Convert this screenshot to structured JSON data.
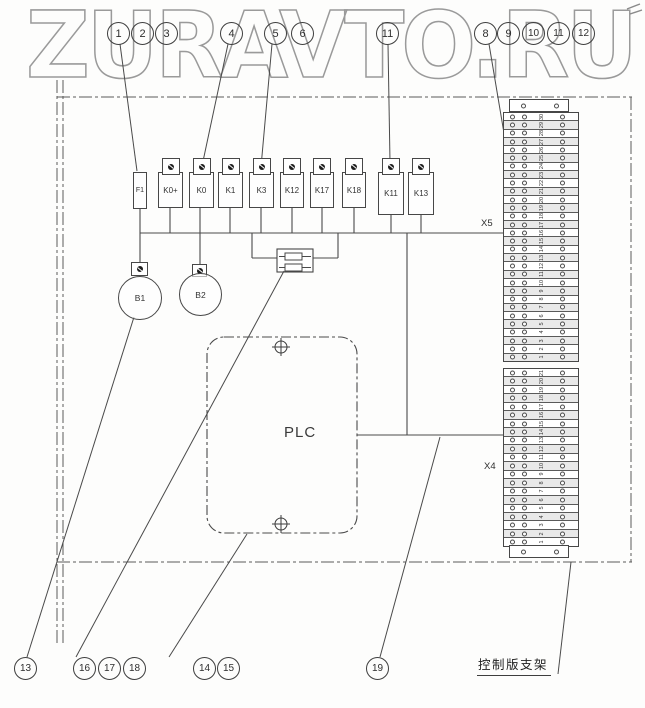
{
  "watermark": {
    "text": "ZURAVTO.RU"
  },
  "callouts": {
    "top": [
      "1",
      "2",
      "3",
      "4",
      "5",
      "6",
      "11",
      "8",
      "9",
      "10",
      "11",
      "12"
    ],
    "bottom": [
      "13",
      "16",
      "17",
      "18",
      "14",
      "15",
      "19"
    ]
  },
  "components": {
    "fuse": "F1",
    "relays": [
      "K0+",
      "K0",
      "K1",
      "K3",
      "K12",
      "K17",
      "K18",
      "K11",
      "K13"
    ],
    "motors": [
      "B1",
      "B2"
    ],
    "plc": "PLC"
  },
  "strips": {
    "x5": {
      "label": "X5",
      "terminals": [
        "30",
        "29",
        "28",
        "27",
        "26",
        "25",
        "24",
        "23",
        "22",
        "21",
        "20",
        "19",
        "18",
        "17",
        "16",
        "15",
        "14",
        "13",
        "12",
        "11",
        "10",
        "9",
        "8",
        "7",
        "6",
        "5",
        "4",
        "3",
        "2",
        "1"
      ]
    },
    "x4": {
      "label": "X4",
      "terminals": [
        "21",
        "20",
        "19",
        "18",
        "17",
        "16",
        "15",
        "14",
        "13",
        "12",
        "11",
        "10",
        "9",
        "8",
        "7",
        "6",
        "5",
        "4",
        "3",
        "2",
        "1"
      ]
    }
  },
  "bracket_label": "控制版支架",
  "colors": {
    "line": "#4a4a4a",
    "border_dashdot": "#5a5a5a",
    "watermark": "#9a9a9a"
  }
}
